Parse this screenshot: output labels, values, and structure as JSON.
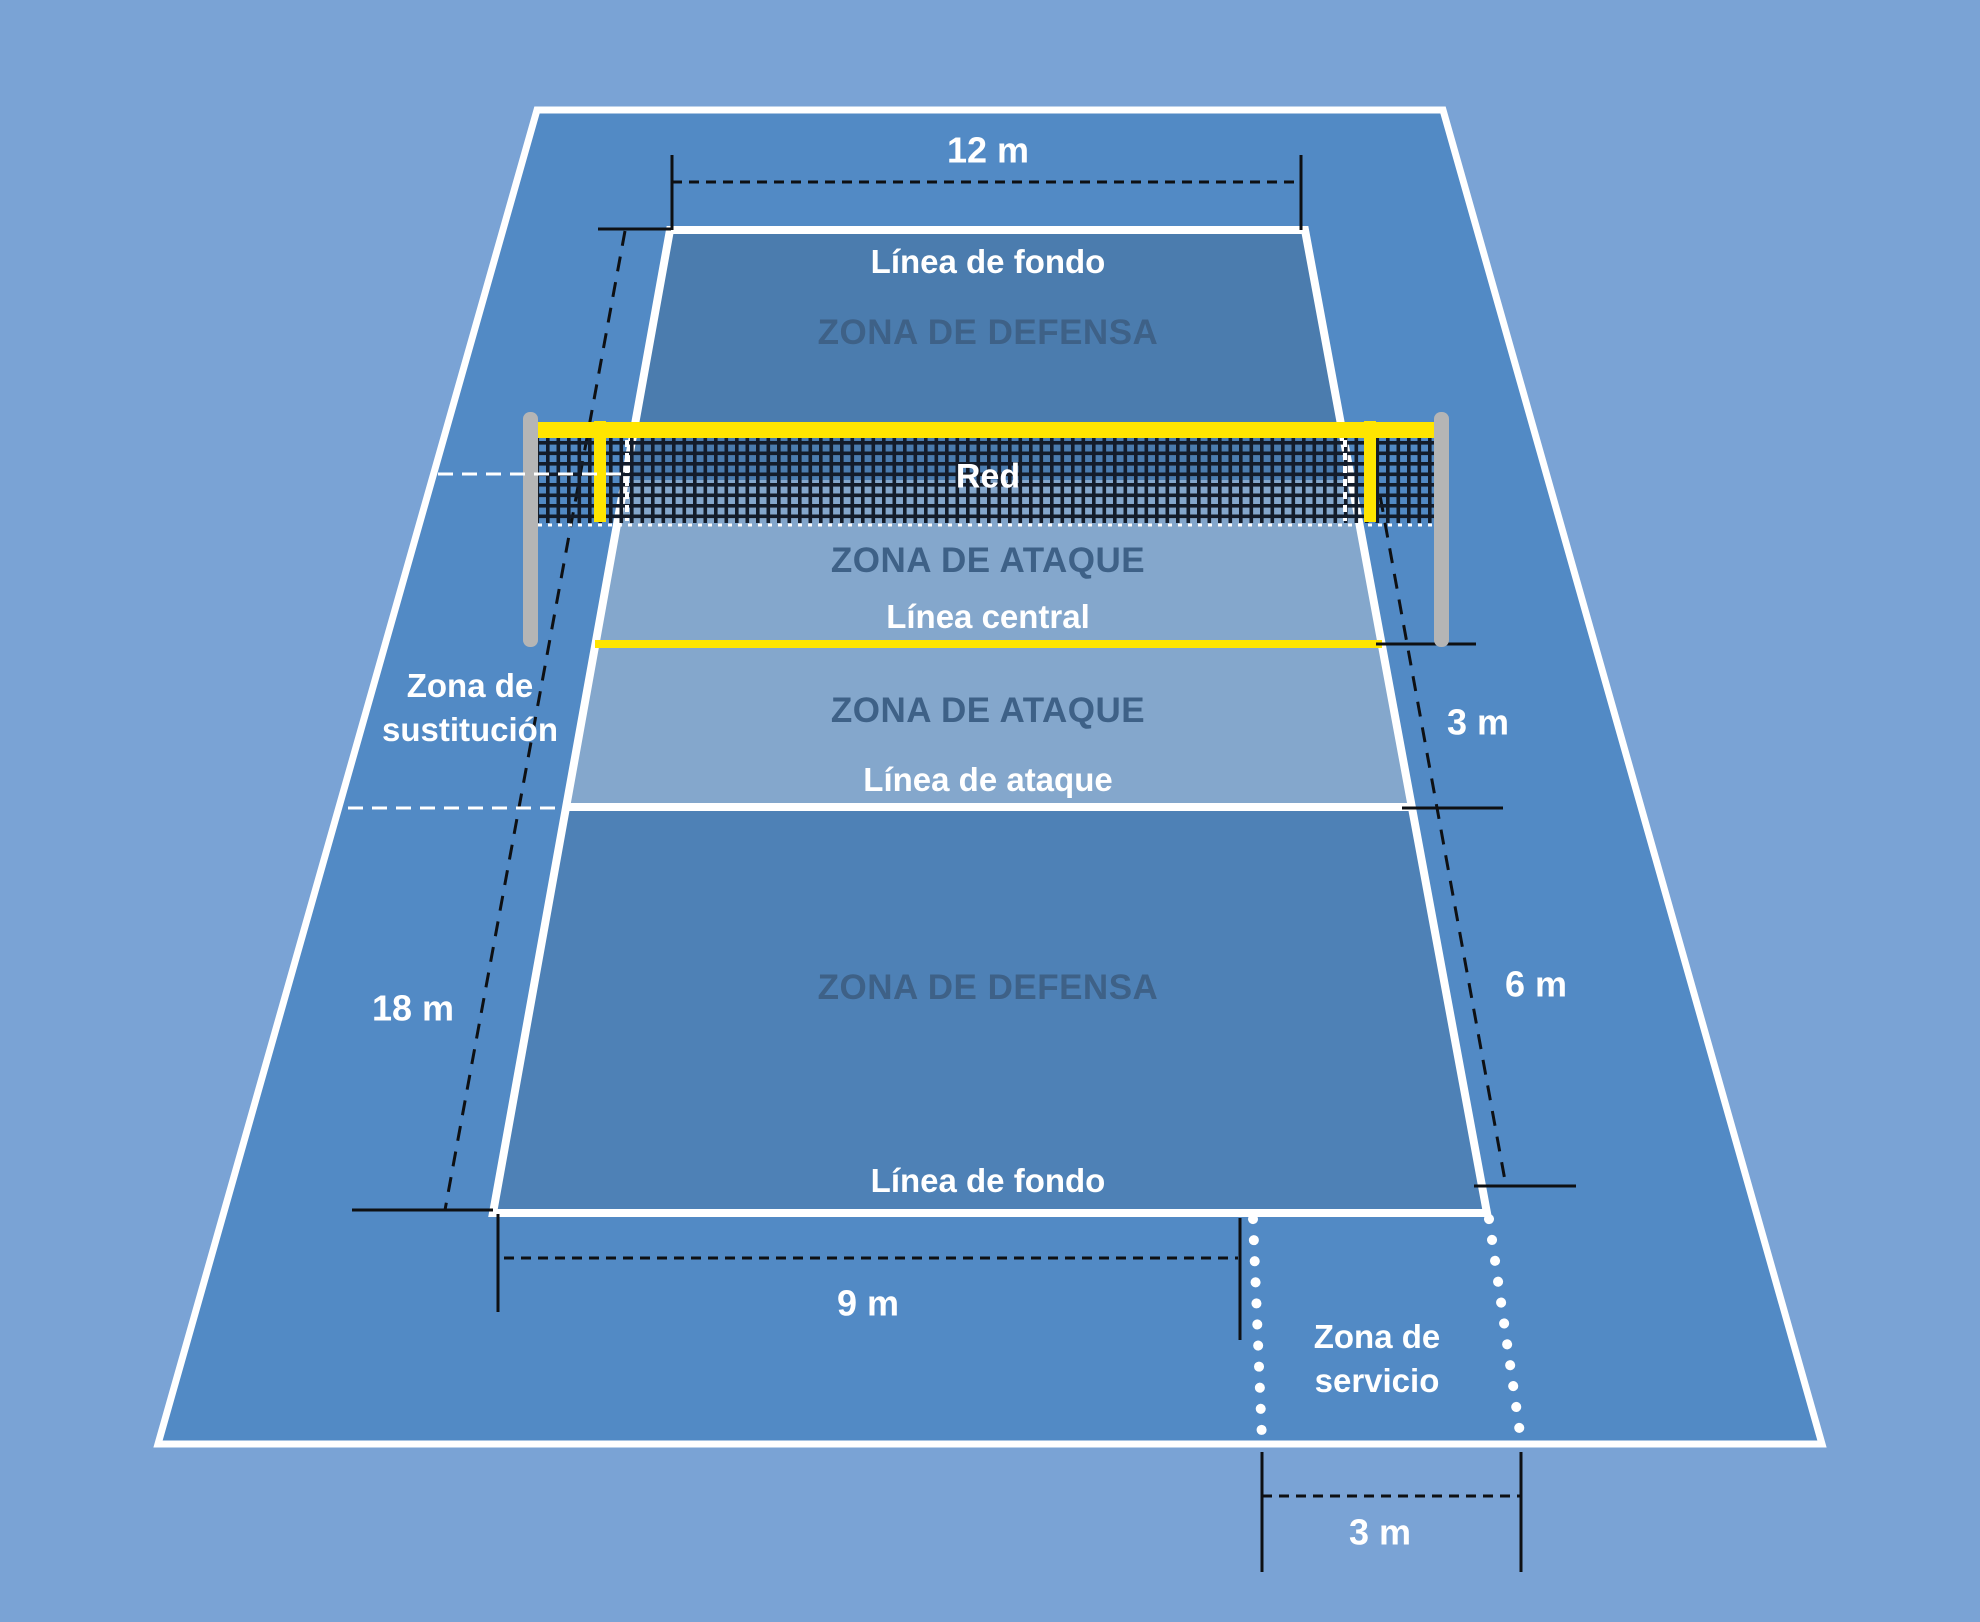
{
  "labels": {
    "baseline_top": "Línea de fondo",
    "defense_zone_top": "ZONA DE DEFENSA",
    "net": "Red",
    "attack_zone_upper": "ZONA DE ATAQUE",
    "center_line": "Línea central",
    "attack_zone_lower": "ZONA DE ATAQUE",
    "attack_line": "Línea de ataque",
    "defense_zone_bottom": "ZONA DE DEFENSA",
    "baseline_bottom": "Línea de fondo",
    "substitution_zone_line1": "Zona de",
    "substitution_zone_line2": "sustitución",
    "service_zone_line1": "Zona de",
    "service_zone_line2": "servicio"
  },
  "dimensions": {
    "court_top_width": "12 m",
    "court_length": "18 m",
    "attack_depth": "3 m",
    "back_depth": "6 m",
    "court_bottom_width": "9 m",
    "service_zone_width": "3 m"
  },
  "colors": {
    "background": "#7AA3D5",
    "free_zone": "#528AC5",
    "defense_zone_top": "#4B7CAE",
    "defense_zone_bottom": "#4E81B6",
    "attack_zone": "#84A7CC",
    "line_white": "#FFFFFF",
    "line_yellow": "#FFE500",
    "net_mesh": "#131C2A",
    "post_gray": "#B5B5B5",
    "zone_text": "#3E6187",
    "dimension_marks": "#0E1013"
  }
}
